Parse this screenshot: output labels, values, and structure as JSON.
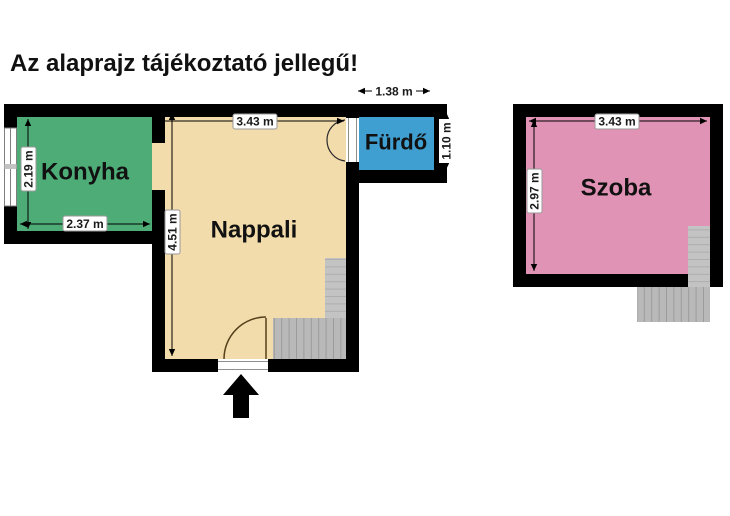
{
  "title": "Az alaprajz tájékoztató jellegű!",
  "rooms": {
    "konyha": {
      "label": "Konyha",
      "width": "2.37 m",
      "height": "2.19 m",
      "color": "#4ead77"
    },
    "nappali": {
      "label": "Nappali",
      "width": "3.43 m",
      "height": "4.51 m",
      "color": "#f3dcab"
    },
    "furdo": {
      "label": "Fürdő",
      "width": "1.38 m",
      "height": "1.10 m",
      "color": "#3f9fd1"
    },
    "szoba": {
      "label": "Szoba",
      "width": "3.43 m",
      "height": "2.97 m",
      "color": "#e093b4"
    }
  },
  "colors": {
    "wall": "#000000",
    "dim_line": "#000000",
    "stair_fill": "#c3c3c3",
    "stair_line": "#aeaeae",
    "stair_run_fill": "#b9b9b9",
    "stair_run_line": "#9b9b9b",
    "door": "#54401a",
    "door_dark": "#2a2a2a",
    "threshold_line": "#8f8f8f",
    "window_frame": "#7f7f7f",
    "entrance_arrow": "#000000"
  }
}
